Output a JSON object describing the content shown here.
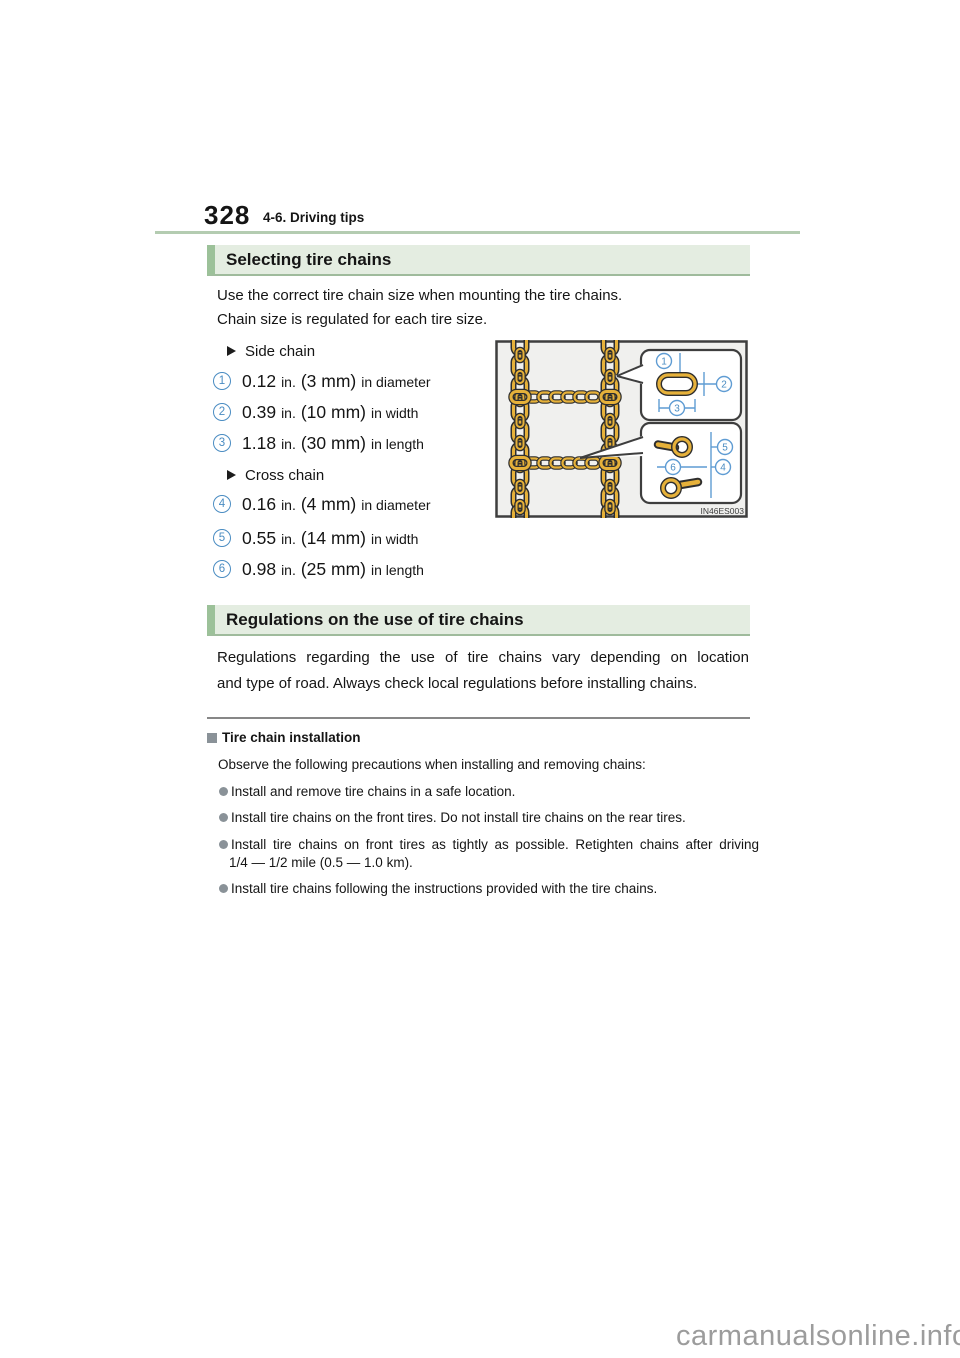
{
  "page_header": {
    "page_number": "328",
    "section_label": "4-6. Driving tips"
  },
  "selecting_section": {
    "title": "Selecting tire chains",
    "intro_lines": [
      "Use the correct tire chain size when mounting the tire chains.",
      "Chain size is regulated for each tire size."
    ],
    "side_chain": {
      "label": "Side chain",
      "items": [
        {
          "num": "1",
          "value": "0.12",
          "unit": "in.",
          "metric": "(3 mm)",
          "suffix": "in diameter"
        },
        {
          "num": "2",
          "value": "0.39",
          "unit": "in.",
          "metric": "(10 mm)",
          "suffix": "in width"
        },
        {
          "num": "3",
          "value": "1.18",
          "unit": "in.",
          "metric": "(30 mm)",
          "suffix": "in length"
        }
      ]
    },
    "cross_chain": {
      "label": "Cross chain",
      "items": [
        {
          "num": "4",
          "value": "0.16",
          "unit": "in.",
          "metric": "(4 mm)",
          "suffix": "in diameter"
        },
        {
          "num": "5",
          "value": "0.55",
          "unit": "in.",
          "metric": "(14 mm)",
          "suffix": "in width"
        },
        {
          "num": "6",
          "value": "0.98",
          "unit": "in.",
          "metric": "(25 mm)",
          "suffix": "in length"
        }
      ]
    },
    "figure": {
      "code": "IN46ES003",
      "callouts": {
        "c1": "1",
        "c2": "2",
        "c3": "3",
        "c4": "4",
        "c5": "5",
        "c6": "6"
      }
    }
  },
  "regulations_section": {
    "title": "Regulations on the use of tire chains",
    "body_lines": [
      "Regulations regarding the use of tire chains vary depending on location",
      "and type of road. Always check local regulations before installing chains."
    ]
  },
  "installation_note": {
    "title": "Tire chain installation",
    "intro": "Observe the following precautions when installing and removing chains:",
    "bullets": [
      {
        "lines": [
          "Install and remove tire chains in a safe location."
        ]
      },
      {
        "lines": [
          "Install tire chains on the front tires. Do not install tire chains on the rear tires."
        ]
      },
      {
        "lines": [
          "Install tire chains on front tires as tightly as possible. Retighten chains after driving",
          "1/4 — 1/2 mile (0.5 — 1.0 km)."
        ]
      },
      {
        "lines": [
          "Install tire chains following the instructions provided with the tire chains."
        ]
      }
    ]
  },
  "watermark": "carmanualsonline.info",
  "colors": {
    "section_bar_bg": "#e4ede1",
    "section_bar_accent": "#9cc199",
    "section_bar_border": "#9fbb9c",
    "header_rule_green": "#b4ccb1",
    "callout_blue": "#4a8cc2",
    "chain_gold": "#e6b13a",
    "note_gray": "#8a9298",
    "divider_gray": "#878787",
    "watermark_gray": "#9c9c9c"
  }
}
